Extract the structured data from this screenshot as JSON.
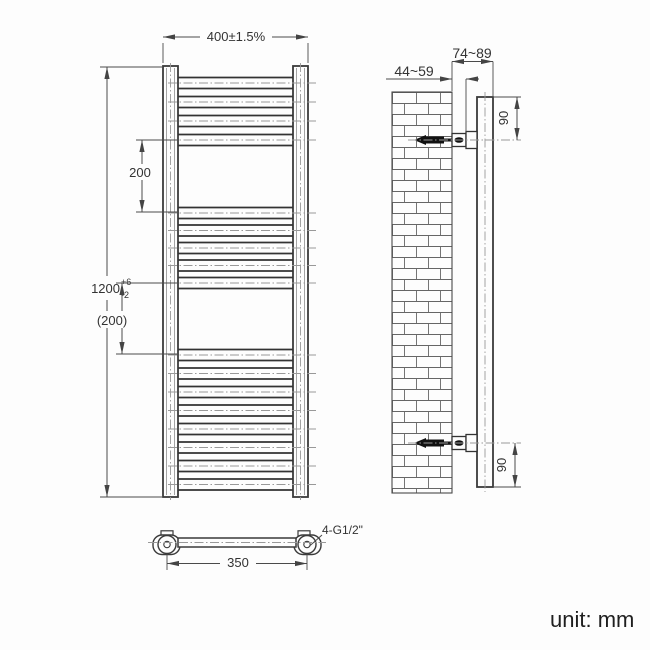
{
  "unit_label": "unit: mm",
  "front_view": {
    "width_dim": "400±1.5%",
    "height_dim_value": "1200",
    "height_tol_plus": "+6",
    "height_tol_minus": "-2",
    "upper_spacing_dim": "200",
    "lower_spacing_dim": "(200)",
    "bar_centers_top": [
      83,
      102,
      121,
      140
    ],
    "bar_centers_middle": [
      213,
      230.5,
      248,
      265.5,
      283
    ],
    "bar_centers_bottom": [
      355,
      373.5,
      392,
      410.5,
      429,
      447.5,
      466,
      484.5
    ]
  },
  "plan_view": {
    "pipe_spacing_dim": "350",
    "connections_label": "4-G1/2\""
  },
  "side_view": {
    "wall_to_pipe_center_dim": "44~59",
    "wall_to_front_dim": "74~89",
    "top_bracket_offset_dim": "90",
    "bottom_bracket_offset_dim": "90"
  },
  "colors": {
    "object_line": "#3a3a3a",
    "dim_line": "#4a4a4a",
    "centerline": "#999999",
    "text": "#333333",
    "background": "#fdfdfd"
  }
}
